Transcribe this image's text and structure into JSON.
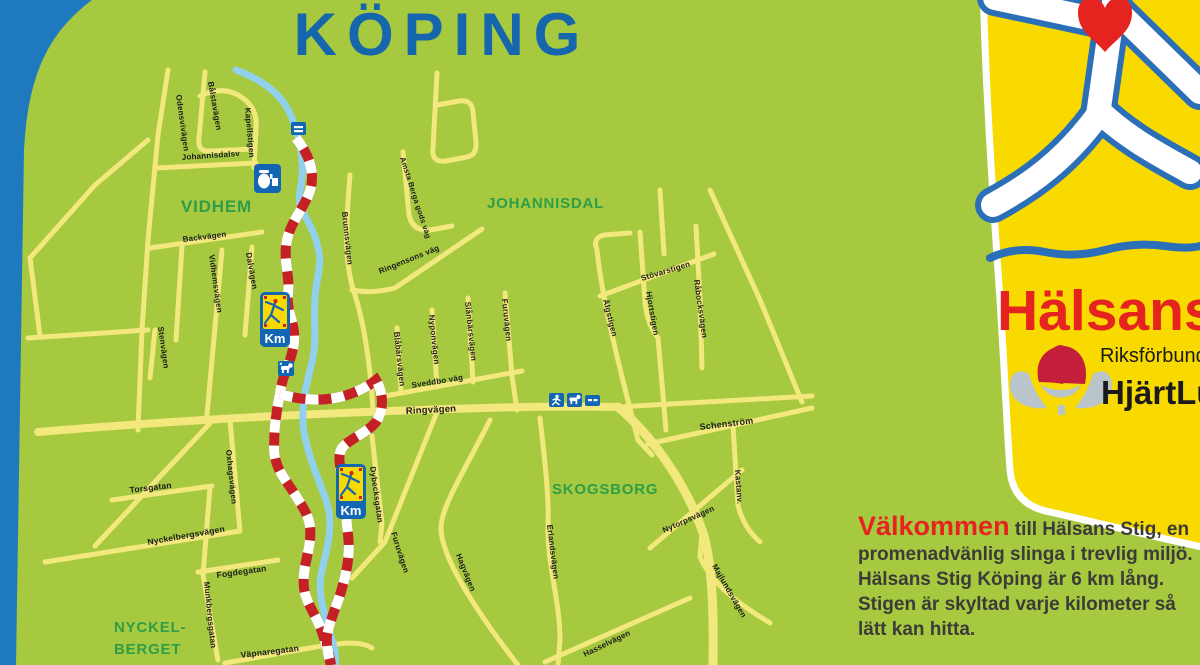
{
  "title": "KÖPING",
  "colors": {
    "background": "#A6C93F",
    "road_yellow": "#F2E87E",
    "river_blue": "#92D1ED",
    "trail_red": "#C52026",
    "title_blue": "#1566AD",
    "area_green": "#2F9E49",
    "panel_yellow": "#F8D900",
    "brand_red": "#E5231F",
    "sign_blue": "#1366B2",
    "border_blue": "#1E79BE"
  },
  "map": {
    "km_label": "Km",
    "areas": [
      {
        "name": "VIDHEM",
        "x": 181,
        "y": 212,
        "size": 17
      },
      {
        "name": "JOHANNISDAL",
        "x": 487,
        "y": 208,
        "size": 15
      },
      {
        "name": "SKOGSBORG",
        "x": 552,
        "y": 494,
        "size": 15
      },
      {
        "name": "NYCKEL-",
        "x": 114,
        "y": 632,
        "size": 15
      },
      {
        "name": "BERGET",
        "x": 114,
        "y": 654,
        "size": 15
      }
    ],
    "streets": [
      {
        "name": "Odensvivägen",
        "x": 176,
        "y": 95,
        "rot": 82,
        "size": 8
      },
      {
        "name": "Bålstavägen",
        "x": 208,
        "y": 82,
        "rot": 80,
        "size": 8
      },
      {
        "name": "Kapellstigen",
        "x": 245,
        "y": 108,
        "rot": 85,
        "size": 8
      },
      {
        "name": "Johannisdalsv",
        "x": 182,
        "y": 160,
        "rot": -4,
        "size": 8
      },
      {
        "name": "Backvägen",
        "x": 183,
        "y": 242,
        "rot": -7,
        "size": 8
      },
      {
        "name": "Vidhemsvägen",
        "x": 209,
        "y": 255,
        "rot": 82,
        "size": 8
      },
      {
        "name": "Dalvägen",
        "x": 246,
        "y": 253,
        "rot": 80,
        "size": 8
      },
      {
        "name": "Stenvägen",
        "x": 158,
        "y": 327,
        "rot": 82,
        "size": 8
      },
      {
        "name": "Brunnsvägen",
        "x": 342,
        "y": 212,
        "rot": 84,
        "size": 8
      },
      {
        "name": "Ringensons väg",
        "x": 380,
        "y": 274,
        "rot": -22,
        "size": 8
      },
      {
        "name": "Amsta Berga gods väg",
        "x": 400,
        "y": 158,
        "rot": 72,
        "size": 7.5
      },
      {
        "name": "Blåbärsvägen",
        "x": 394,
        "y": 332,
        "rot": 84,
        "size": 8
      },
      {
        "name": "Nyponvägen",
        "x": 429,
        "y": 315,
        "rot": 84,
        "size": 8
      },
      {
        "name": "Slånbärsvägen",
        "x": 465,
        "y": 302,
        "rot": 84,
        "size": 8
      },
      {
        "name": "Furuvägen",
        "x": 502,
        "y": 299,
        "rot": 84,
        "size": 8
      },
      {
        "name": "Sveddbo väg",
        "x": 412,
        "y": 388,
        "rot": -9,
        "size": 8
      },
      {
        "name": "Ringvägen",
        "x": 406,
        "y": 414,
        "rot": -3,
        "size": 9.5
      },
      {
        "name": "Stövarstigen",
        "x": 642,
        "y": 281,
        "rot": -17,
        "size": 8
      },
      {
        "name": "Älgstigen",
        "x": 603,
        "y": 300,
        "rot": 76,
        "size": 8
      },
      {
        "name": "Hjortstigen",
        "x": 646,
        "y": 292,
        "rot": 80,
        "size": 8
      },
      {
        "name": "Råbocksvägen",
        "x": 694,
        "y": 280,
        "rot": 82,
        "size": 8
      },
      {
        "name": "Schenström",
        "x": 700,
        "y": 430,
        "rot": -7,
        "size": 9
      },
      {
        "name": "Kastanv.",
        "x": 735,
        "y": 470,
        "rot": 86,
        "size": 8
      },
      {
        "name": "Nytorpsvägen",
        "x": 664,
        "y": 533,
        "rot": -24,
        "size": 8
      },
      {
        "name": "Majlundsvägen",
        "x": 712,
        "y": 566,
        "rot": 60,
        "size": 8
      },
      {
        "name": "Furuvägen",
        "x": 391,
        "y": 533,
        "rot": 72,
        "size": 8
      },
      {
        "name": "Hagvägen",
        "x": 456,
        "y": 555,
        "rot": 68,
        "size": 8
      },
      {
        "name": "Erlandsvägen",
        "x": 547,
        "y": 525,
        "rot": 83,
        "size": 8
      },
      {
        "name": "Hasselvägen",
        "x": 585,
        "y": 657,
        "rot": -26,
        "size": 8
      },
      {
        "name": "Dybecksgatan",
        "x": 370,
        "y": 467,
        "rot": 82,
        "size": 8
      },
      {
        "name": "Oxhagsvägen",
        "x": 226,
        "y": 450,
        "rot": 84,
        "size": 8
      },
      {
        "name": "Torsgatan",
        "x": 130,
        "y": 493,
        "rot": -7,
        "size": 8.5
      },
      {
        "name": "Nyckelbergsvägen",
        "x": 148,
        "y": 545,
        "rot": -10,
        "size": 8.5
      },
      {
        "name": "Fogdegatan",
        "x": 217,
        "y": 578,
        "rot": -8,
        "size": 8.5
      },
      {
        "name": "Munkbergsgatan",
        "x": 204,
        "y": 582,
        "rot": 84,
        "size": 8
      },
      {
        "name": "Väpnaregatan",
        "x": 241,
        "y": 658,
        "rot": -7,
        "size": 8.5
      }
    ],
    "icons": [
      {
        "name": "bench-icon"
      },
      {
        "name": "kiosk-icon"
      },
      {
        "name": "dog-icon"
      },
      {
        "name": "runner-icon"
      },
      {
        "name": "dog-icon-2"
      },
      {
        "name": "bench-icon-2"
      }
    ]
  },
  "panel": {
    "brand": "Hälsans",
    "org_small": "Riksförbundet",
    "org_bold": "HjärtLung"
  },
  "welcome": {
    "highlight": "Välkommen",
    "intro_rest": " till Hälsans Stig, en",
    "lines": [
      "promenadvänlig slinga i trevlig miljö.",
      "Hälsans Stig Köping är 6 km lång.",
      "Stigen är skyltad varje kilometer så",
      "lätt kan hitta."
    ]
  }
}
